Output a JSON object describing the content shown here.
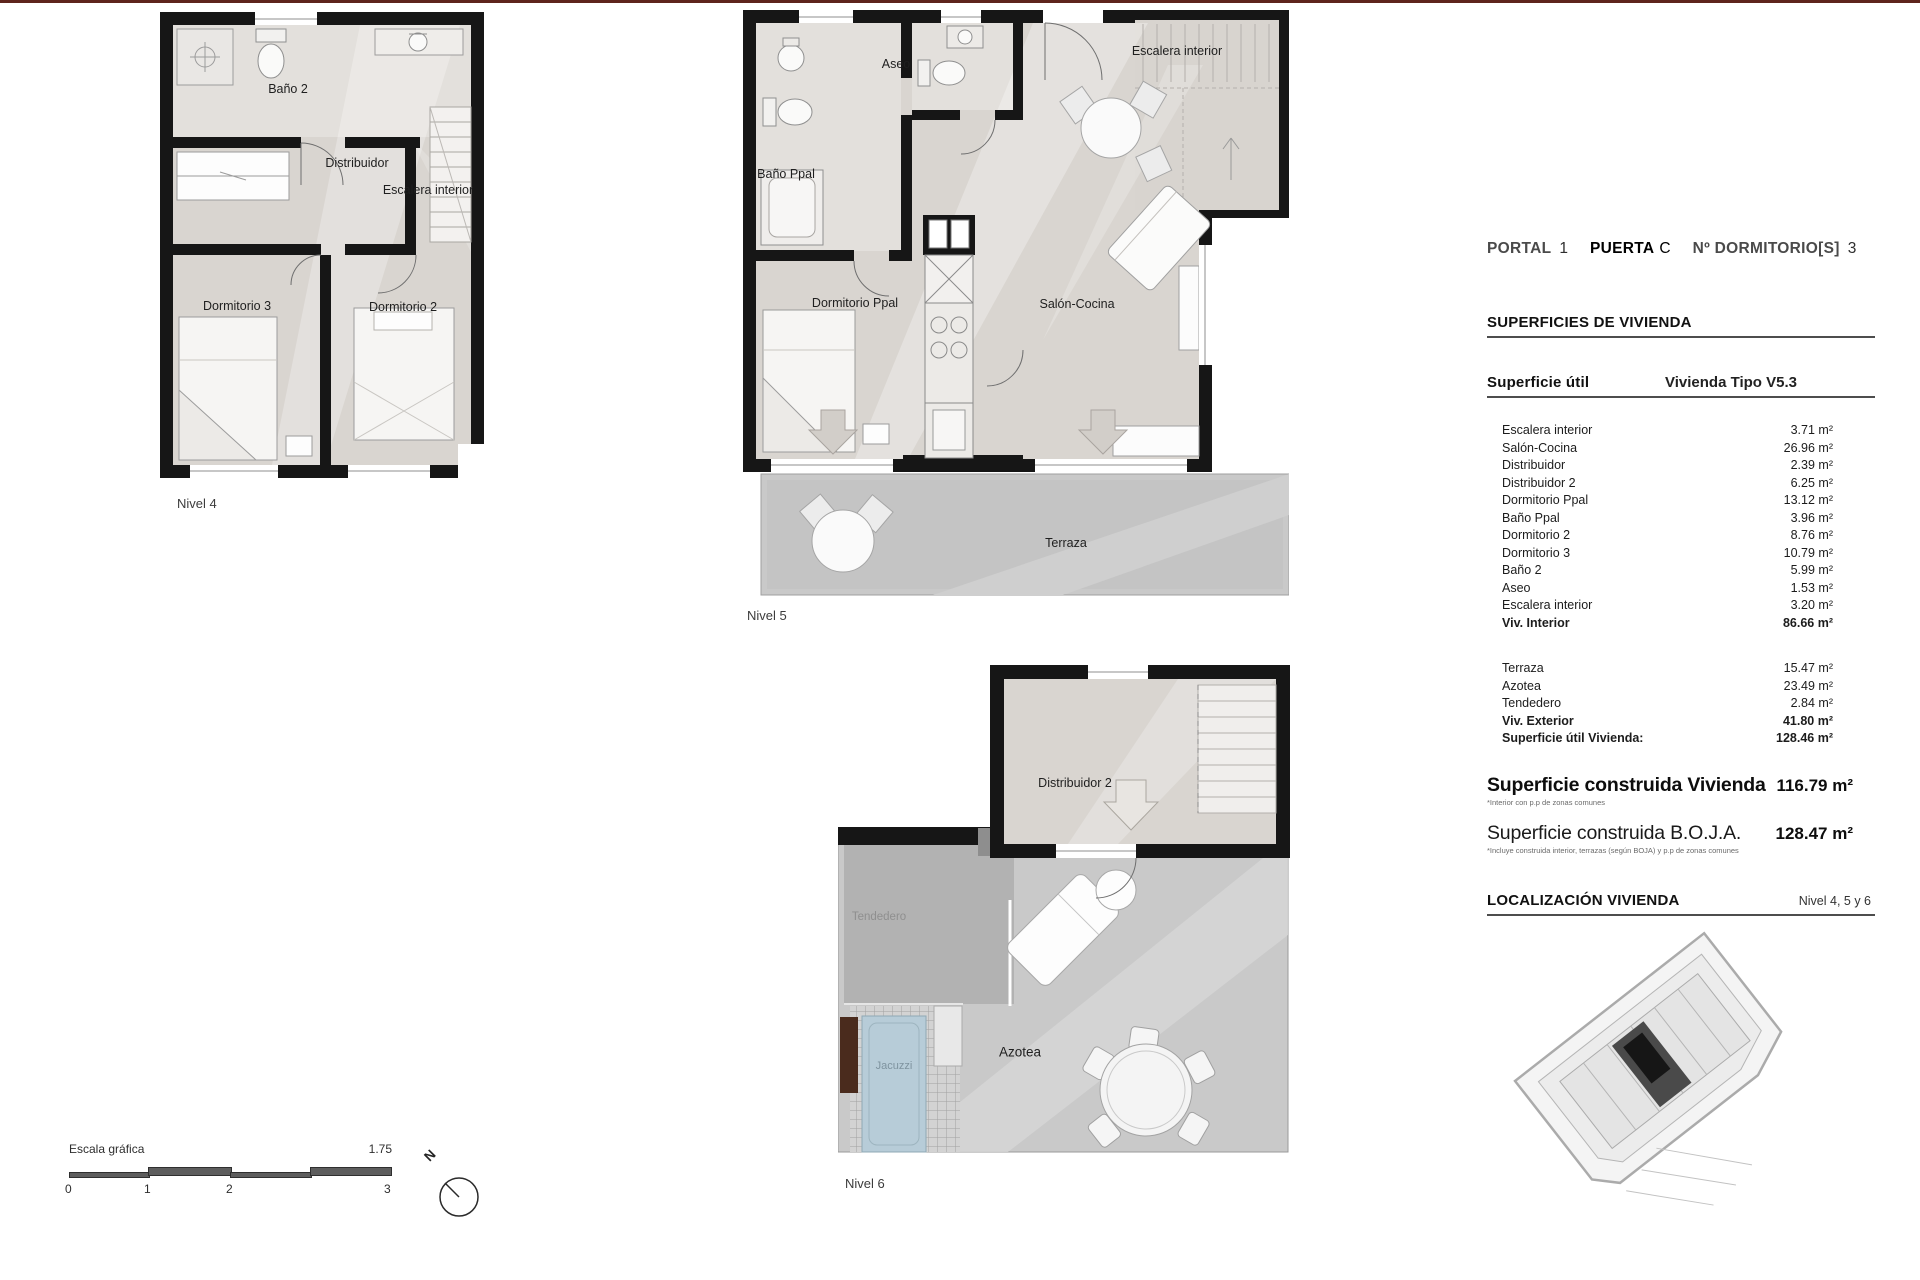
{
  "header": {
    "portal_label": "PORTAL",
    "portal_value": "1",
    "puerta_label": "PUERTA",
    "puerta_value": "C",
    "dorm_label": "Nº DORMITORIO[S]",
    "dorm_value": "3"
  },
  "surfaces": {
    "title": "SUPERFICIES DE VIVIENDA",
    "util_header": {
      "label": "Superficie útil",
      "value": "Vivienda Tipo V5.3"
    },
    "util_rows": [
      {
        "label": "Escalera interior",
        "value": "3.71 m²"
      },
      {
        "label": "Salón-Cocina",
        "value": "26.96 m²"
      },
      {
        "label": "Distribuidor",
        "value": "2.39 m²"
      },
      {
        "label": "Distribuidor 2",
        "value": "6.25 m²"
      },
      {
        "label": "Dormitorio Ppal",
        "value": "13.12 m²"
      },
      {
        "label": "Baño Ppal",
        "value": "3.96 m²"
      },
      {
        "label": "Dormitorio 2",
        "value": "8.76 m²"
      },
      {
        "label": "Dormitorio 3",
        "value": "10.79 m²"
      },
      {
        "label": "Baño 2",
        "value": "5.99 m²"
      },
      {
        "label": "Aseo",
        "value": "1.53 m²"
      },
      {
        "label": "Escalera interior",
        "value": "3.20 m²"
      }
    ],
    "interior_total": {
      "label": "Viv. Interior",
      "value": "86.66 m²"
    },
    "exterior_rows": [
      {
        "label": "Terraza",
        "value": "15.47 m²"
      },
      {
        "label": "Azotea",
        "value": "23.49 m²"
      },
      {
        "label": "Tendedero",
        "value": "2.84 m²"
      }
    ],
    "exterior_total": {
      "label": "Viv. Exterior",
      "value": "41.80 m²"
    },
    "util_total": {
      "label": "Superficie útil Vivienda:",
      "value": "128.46 m²"
    },
    "construida": {
      "label": "Superficie construida Vivienda",
      "value": "116.79 m²",
      "footnote": "*Interior con p.p de zonas comunes"
    },
    "boja": {
      "label": "Superficie construida B.O.J.A.",
      "value": "128.47 m²",
      "footnote": "*Incluye construida interior, terrazas (según BOJA) y p.p de zonas comunes"
    }
  },
  "localizacion": {
    "title": "LOCALIZACIÓN VIVIENDA",
    "nivel": "Nivel 4, 5 y 6"
  },
  "plans": {
    "nivel4": {
      "caption": "Nivel 4",
      "rooms": {
        "bano2": "Baño 2",
        "distribuidor": "Distribuidor",
        "escalera": "Escalera interior",
        "dorm3": "Dormitorio 3",
        "dorm2": "Dormitorio 2"
      }
    },
    "nivel5": {
      "caption": "Nivel 5",
      "rooms": {
        "aseo": "Aseo",
        "bano_ppal": "Baño Ppal",
        "escalera": "Escalera interior",
        "dorm_ppal": "Dormitorio Ppal",
        "salon": "Salón-Cocina",
        "terraza": "Terraza"
      }
    },
    "nivel6": {
      "caption": "Nivel 6",
      "rooms": {
        "distribuidor2": "Distribuidor 2",
        "tendedero": "Tendedero",
        "jacuzzi": "Jacuzzi",
        "azotea": "Azotea"
      }
    }
  },
  "scale": {
    "label": "Escala gráfica",
    "ratio": "1.75",
    "ticks": [
      "0",
      "1",
      "2",
      "3"
    ],
    "north": "N"
  }
}
